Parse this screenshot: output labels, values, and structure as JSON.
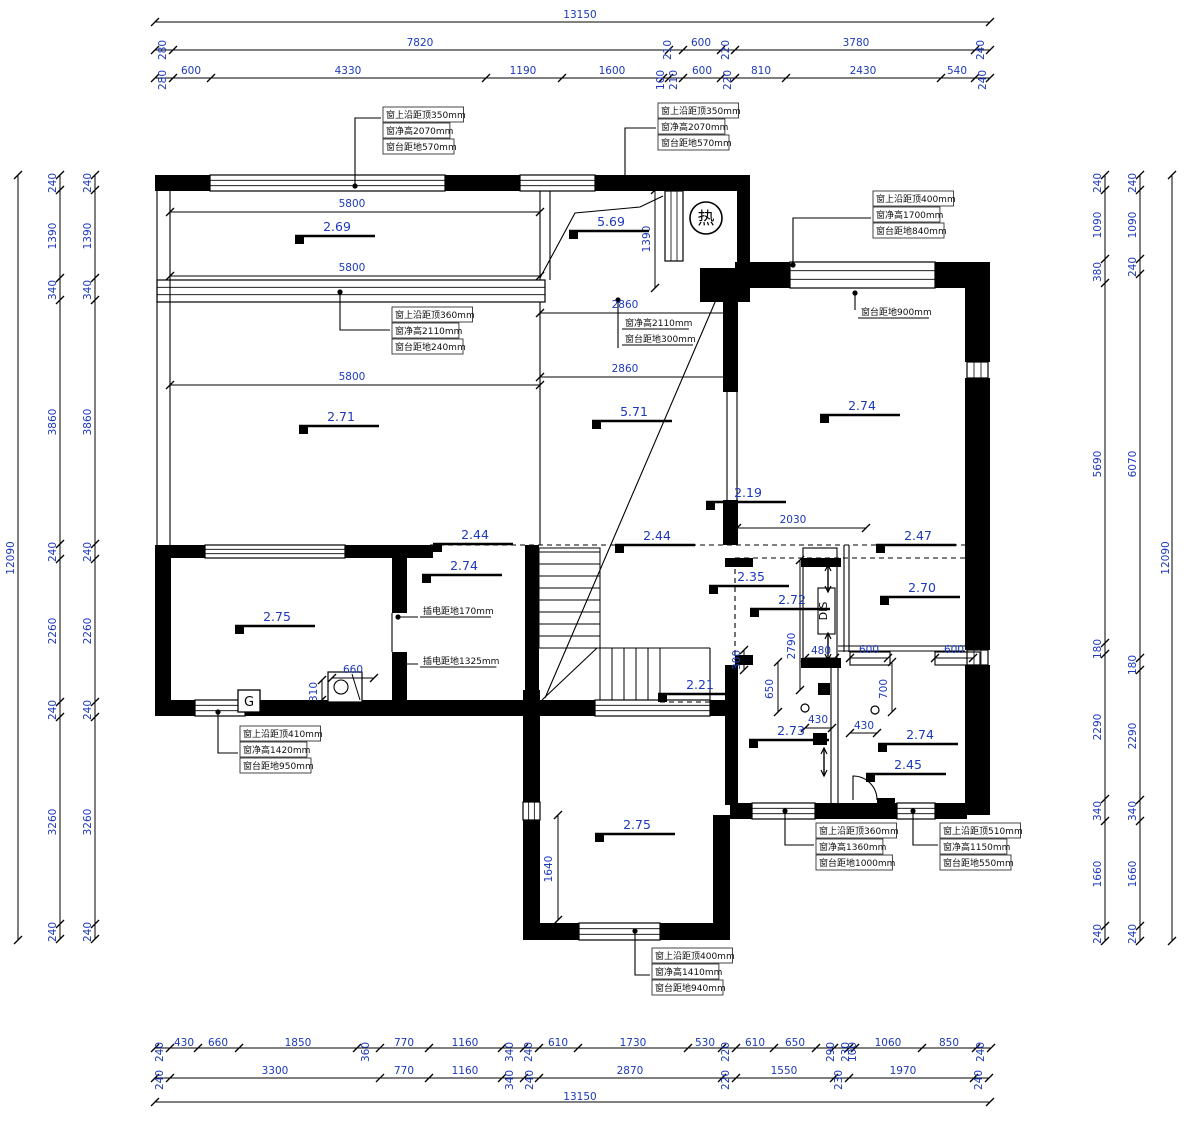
{
  "palette": {
    "line": "#000000",
    "dim_text": "#1c39bb",
    "note_text": "#101010",
    "bg": "#ffffff"
  },
  "dims": [
    [
      "13150",
      580,
      18,
      0
    ],
    [
      "280",
      166,
      50,
      1
    ],
    [
      "7820",
      420,
      46,
      0
    ],
    [
      "210",
      671,
      50,
      1
    ],
    [
      "600",
      701,
      46,
      0
    ],
    [
      "220",
      729,
      50,
      1
    ],
    [
      "3780",
      856,
      46,
      0
    ],
    [
      "240",
      984,
      50,
      1
    ],
    [
      "280",
      166,
      80,
      1
    ],
    [
      "600",
      191,
      74,
      0
    ],
    [
      "4330",
      348,
      74,
      0
    ],
    [
      "1190",
      523,
      74,
      0
    ],
    [
      "1600",
      612,
      74,
      0
    ],
    [
      "100",
      664,
      80,
      1
    ],
    [
      "210",
      677,
      80,
      1
    ],
    [
      "600",
      702,
      74,
      0
    ],
    [
      "220",
      731,
      80,
      1
    ],
    [
      "810",
      761,
      74,
      0
    ],
    [
      "2430",
      863,
      74,
      0
    ],
    [
      "540",
      957,
      74,
      0
    ],
    [
      "240",
      986,
      80,
      1
    ],
    [
      "240",
      56,
      183,
      1
    ],
    [
      "1390",
      56,
      236,
      1
    ],
    [
      "340",
      56,
      290,
      1
    ],
    [
      "3860",
      56,
      422,
      1
    ],
    [
      "240",
      56,
      552,
      1
    ],
    [
      "2260",
      56,
      631,
      1
    ],
    [
      "240",
      56,
      710,
      1
    ],
    [
      "3260",
      56,
      822,
      1
    ],
    [
      "240",
      56,
      932,
      1
    ],
    [
      "240",
      91,
      183,
      1
    ],
    [
      "1390",
      91,
      236,
      1
    ],
    [
      "340",
      91,
      290,
      1
    ],
    [
      "3860",
      91,
      422,
      1
    ],
    [
      "240",
      91,
      552,
      1
    ],
    [
      "2260",
      91,
      631,
      1
    ],
    [
      "240",
      91,
      710,
      1
    ],
    [
      "3260",
      91,
      822,
      1
    ],
    [
      "240",
      91,
      932,
      1
    ],
    [
      "12090",
      14,
      558,
      1
    ],
    [
      "240",
      1101,
      183,
      1
    ],
    [
      "1090",
      1101,
      225,
      1
    ],
    [
      "380",
      1101,
      272,
      1
    ],
    [
      "5690",
      1101,
      464,
      1
    ],
    [
      "180",
      1101,
      649,
      1
    ],
    [
      "2290",
      1101,
      727,
      1
    ],
    [
      "340",
      1101,
      811,
      1
    ],
    [
      "1660",
      1101,
      874,
      1
    ],
    [
      "240",
      1101,
      934,
      1
    ],
    [
      "240",
      1136,
      183,
      1
    ],
    [
      "1090",
      1136,
      225,
      1
    ],
    [
      "240",
      1136,
      267,
      1
    ],
    [
      "6070",
      1136,
      464,
      1
    ],
    [
      "180",
      1136,
      665,
      1
    ],
    [
      "2290",
      1136,
      736,
      1
    ],
    [
      "340",
      1136,
      811,
      1
    ],
    [
      "1660",
      1136,
      874,
      1
    ],
    [
      "240",
      1136,
      934,
      1
    ],
    [
      "12090",
      1169,
      558,
      1
    ],
    [
      "240",
      163,
      1052,
      1
    ],
    [
      "430",
      184,
      1046,
      0
    ],
    [
      "660",
      218,
      1046,
      0
    ],
    [
      "1850",
      298,
      1046,
      0
    ],
    [
      "360",
      369,
      1052,
      1
    ],
    [
      "770",
      404,
      1046,
      0
    ],
    [
      "1160",
      465,
      1046,
      0
    ],
    [
      "340",
      513,
      1052,
      1
    ],
    [
      "240",
      532,
      1052,
      1
    ],
    [
      "610",
      558,
      1046,
      0
    ],
    [
      "1730",
      633,
      1046,
      0
    ],
    [
      "530",
      705,
      1046,
      0
    ],
    [
      "220",
      729,
      1052,
      1
    ],
    [
      "610",
      755,
      1046,
      0
    ],
    [
      "650",
      795,
      1046,
      0
    ],
    [
      "290",
      834,
      1052,
      1
    ],
    [
      "230",
      849,
      1052,
      1
    ],
    [
      "100",
      856,
      1052,
      1
    ],
    [
      "1060",
      888,
      1046,
      0
    ],
    [
      "850",
      949,
      1046,
      0
    ],
    [
      "240",
      984,
      1052,
      1
    ],
    [
      "240",
      163,
      1080,
      1
    ],
    [
      "3300",
      275,
      1074,
      0
    ],
    [
      "770",
      404,
      1074,
      0
    ],
    [
      "1160",
      465,
      1074,
      0
    ],
    [
      "340",
      513,
      1080,
      1
    ],
    [
      "240",
      533,
      1080,
      1
    ],
    [
      "2870",
      630,
      1074,
      0
    ],
    [
      "220",
      729,
      1080,
      1
    ],
    [
      "1550",
      784,
      1074,
      0
    ],
    [
      "230",
      842,
      1080,
      1
    ],
    [
      "1970",
      903,
      1074,
      0
    ],
    [
      "240",
      982,
      1080,
      1
    ],
    [
      "13150",
      580,
      1100,
      0
    ],
    [
      "5800",
      352,
      207,
      0
    ],
    [
      "5800",
      352,
      271,
      0
    ],
    [
      "5800",
      352,
      380,
      0
    ],
    [
      "2860",
      625,
      308,
      0
    ],
    [
      "2860",
      625,
      372,
      0
    ],
    [
      "1390",
      650,
      239,
      1
    ],
    [
      "2030",
      793,
      523,
      0
    ],
    [
      "660",
      353,
      673,
      0
    ],
    [
      "310",
      317,
      692,
      1
    ],
    [
      "1640",
      552,
      869,
      1
    ],
    [
      "2790",
      795,
      646,
      1
    ],
    [
      "480",
      821,
      654,
      0
    ],
    [
      "600",
      869,
      653,
      0
    ],
    [
      "600",
      954,
      653,
      0
    ],
    [
      "650",
      773,
      689,
      1
    ],
    [
      "700",
      887,
      689,
      1
    ],
    [
      "300",
      740,
      660,
      1
    ],
    [
      "430",
      818,
      723,
      0
    ],
    [
      "430",
      864,
      729,
      0
    ]
  ],
  "levels": [
    [
      "2.69",
      337,
      231
    ],
    [
      "5.69",
      611,
      226
    ],
    [
      "2.71",
      341,
      421
    ],
    [
      "5.71",
      634,
      416
    ],
    [
      "2.74",
      862,
      410
    ],
    [
      "2.19",
      748,
      497
    ],
    [
      "2.44",
      475,
      539
    ],
    [
      "2.44",
      657,
      540
    ],
    [
      "2.47",
      918,
      540
    ],
    [
      "2.74",
      464,
      570
    ],
    [
      "2.35",
      751,
      581
    ],
    [
      "2.72",
      792,
      604
    ],
    [
      "2.70",
      922,
      592
    ],
    [
      "2.75",
      277,
      621
    ],
    [
      "2.21",
      700,
      689
    ],
    [
      "2.73",
      791,
      735
    ],
    [
      "2.74",
      920,
      739
    ],
    [
      "2.45",
      908,
      769
    ],
    [
      "2.75",
      637,
      829
    ]
  ],
  "notes": [
    {
      "x": 383,
      "y": 118,
      "boxed": true,
      "lines": [
        "窗上沿距顶350mm",
        "窗净高2070mm",
        "窗台距地570mm"
      ]
    },
    {
      "x": 658,
      "y": 114,
      "boxed": true,
      "lines": [
        "窗上沿距顶350mm",
        "窗净高2070mm",
        "窗台距地570mm"
      ]
    },
    {
      "x": 392,
      "y": 318,
      "boxed": true,
      "lines": [
        "窗上沿距顶360mm",
        "窗净高2110mm",
        "窗台距地240mm"
      ]
    },
    {
      "x": 873,
      "y": 202,
      "boxed": true,
      "lines": [
        "窗上沿距顶400mm",
        "窗净高1700mm",
        "窗台距地840mm"
      ]
    },
    {
      "x": 622,
      "y": 326,
      "boxed": false,
      "lines": [
        "窗净高2110mm",
        "窗台距地300mm"
      ]
    },
    {
      "x": 858,
      "y": 315,
      "boxed": false,
      "lines": [
        "窗台距地900mm"
      ]
    },
    {
      "x": 240,
      "y": 737,
      "boxed": true,
      "lines": [
        "窗上沿距顶410mm",
        "窗净高1420mm",
        "窗台距地950mm"
      ]
    },
    {
      "x": 816,
      "y": 834,
      "boxed": true,
      "lines": [
        "窗上沿距顶360mm",
        "窗净高1360mm",
        "窗台距地1000mm"
      ]
    },
    {
      "x": 940,
      "y": 834,
      "boxed": true,
      "lines": [
        "窗上沿距顶510mm",
        "窗净高1150mm",
        "窗台距地550mm"
      ]
    },
    {
      "x": 652,
      "y": 959,
      "boxed": true,
      "lines": [
        "窗上沿距顶400mm",
        "窗净高1410mm",
        "窗台距地940mm"
      ]
    },
    {
      "x": 420,
      "y": 614,
      "boxed": false,
      "lines": [
        "插电距地170mm"
      ]
    },
    {
      "x": 420,
      "y": 664,
      "boxed": false,
      "lines": [
        "插电距地1325mm"
      ]
    }
  ],
  "symbols": {
    "heater": {
      "t": "热",
      "x": 706,
      "y": 218
    },
    "gas": {
      "t": "G",
      "x": 249,
      "y": 701
    },
    "shaft": {
      "t": "DIS",
      "x": 827,
      "y": 611
    }
  },
  "chains": {
    "h": [
      {
        "p": 22,
        "t": [
          155,
          990
        ]
      },
      {
        "p": 50,
        "t": [
          155,
          173,
          669,
          683,
          721,
          735,
          975,
          990
        ]
      },
      {
        "p": 78,
        "t": [
          155,
          173,
          211,
          486,
          562,
          663,
          669,
          683,
          721,
          735,
          786,
          941,
          975,
          990
        ]
      },
      {
        "p": 212,
        "t": [
          170,
          540
        ]
      },
      {
        "p": 276,
        "t": [
          170,
          540
        ]
      },
      {
        "p": 385,
        "t": [
          170,
          540
        ]
      },
      {
        "p": 313,
        "t": [
          540,
          730
        ]
      },
      {
        "p": 377,
        "t": [
          540,
          730
        ]
      },
      {
        "p": 528,
        "t": [
          737,
          866
        ]
      },
      {
        "p": 678,
        "t": [
          332,
          374
        ]
      },
      {
        "p": 658,
        "t": [
          805,
          835
        ]
      },
      {
        "p": 658,
        "t": [
          850,
          888
        ]
      },
      {
        "p": 658,
        "t": [
          935,
          973
        ]
      },
      {
        "p": 728,
        "t": [
          805,
          832
        ]
      },
      {
        "p": 733,
        "t": [
          850,
          877
        ]
      },
      {
        "p": 1048,
        "t": [
          155,
          170,
          198,
          239,
          357,
          380,
          429,
          502,
          524,
          539,
          578,
          688,
          722,
          736,
          774,
          816,
          834,
          849,
          855,
          922,
          976,
          991
        ]
      },
      {
        "p": 1078,
        "t": [
          155,
          170,
          380,
          429,
          502,
          524,
          539,
          722,
          736,
          834,
          849,
          974,
          989
        ]
      },
      {
        "p": 1102,
        "t": [
          155,
          990
        ]
      }
    ],
    "v": [
      {
        "p": 18,
        "t": [
          175,
          940
        ]
      },
      {
        "p": 60,
        "t": [
          175,
          190,
          278,
          300,
          544,
          559,
          702,
          717,
          924,
          939
        ]
      },
      {
        "p": 95,
        "t": [
          175,
          190,
          278,
          300,
          544,
          559,
          702,
          717,
          924,
          939
        ]
      },
      {
        "p": 1105,
        "t": [
          175,
          190,
          259,
          283,
          643,
          654,
          799,
          821,
          926,
          941
        ]
      },
      {
        "p": 1140,
        "t": [
          175,
          190,
          259,
          274,
          658,
          670,
          800,
          821,
          926,
          941
        ]
      },
      {
        "p": 1172,
        "t": [
          175,
          941
        ]
      },
      {
        "p": 655,
        "t": [
          190,
          288
        ]
      },
      {
        "p": 322,
        "t": [
          680,
          700
        ]
      },
      {
        "p": 558,
        "t": [
          815,
          920
        ]
      },
      {
        "p": 800,
        "t": [
          560,
          690
        ]
      },
      {
        "p": 778,
        "t": [
          662,
          712
        ]
      },
      {
        "p": 892,
        "t": [
          662,
          712
        ]
      },
      {
        "p": 744,
        "t": [
          650,
          670
        ]
      }
    ]
  }
}
